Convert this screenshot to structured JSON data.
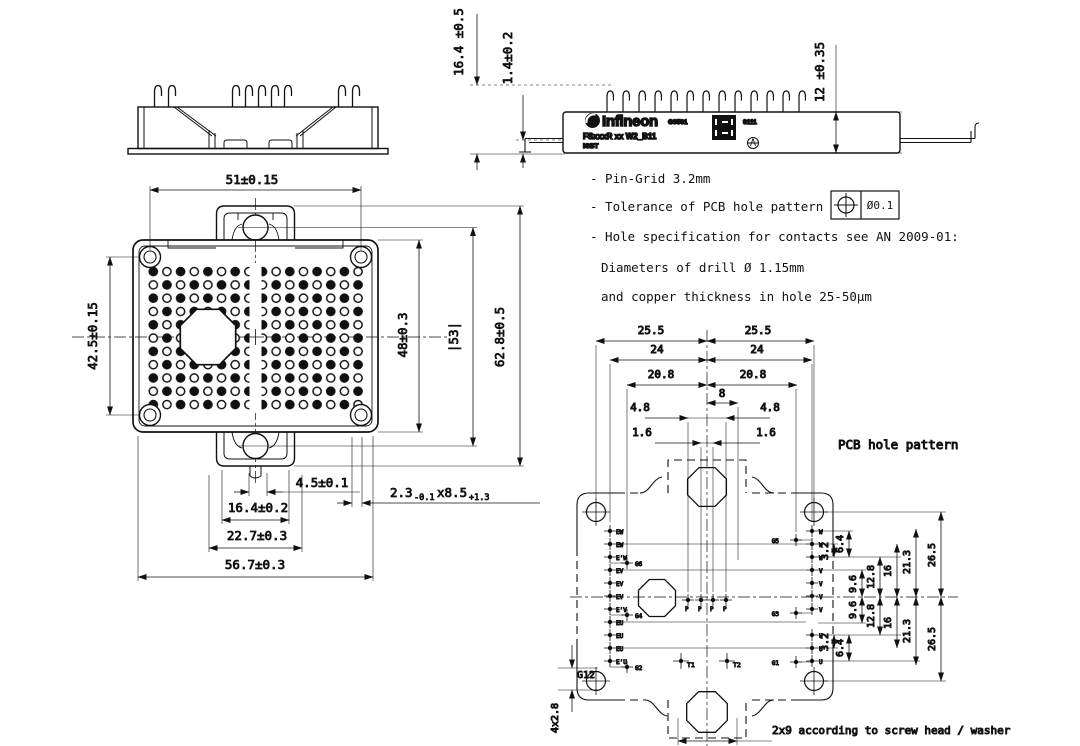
{
  "side_views": {
    "brand": "Infineon",
    "code": "G0501",
    "part": "FSxxxR xx W2_B11",
    "series": "IGBT",
    "batch": "0111"
  },
  "dims": {
    "w51": "51±0.15",
    "h425": "42.5±0.15",
    "h48": "48±0.3",
    "h53": "|53|",
    "h628": "62.8±0.5",
    "w45": "4.5±0.1",
    "w164": "16.4±0.2",
    "w227": "22.7±0.3",
    "w567": "56.7±0.3",
    "slot_main": "2.3",
    "slot_tol1": "-0.1",
    "slot_x": "x8.5",
    "slot_tol2": "+1.3",
    "h164": "16.4 ±0.5",
    "h14": "1.4±0.2",
    "h12": "12 ±0.35"
  },
  "notes": {
    "pin_grid": "- Pin-Grid 3.2mm",
    "tolerance": "- Tolerance of PCB hole pattern",
    "tol_value": "Ø0.1",
    "hole_spec": "- Hole specification for contacts see AN 2009-01:",
    "drill": "Diameters of drill Ø 1.15mm",
    "copper": "and copper thickness in hole 25-50µm"
  },
  "pcb": {
    "title": "PCB hole pattern",
    "screw_note": "2x9 according to screw head / washer",
    "corner_label": "G12",
    "corner_dim": "4x2.8",
    "top_dims": {
      "d255": "25.5",
      "d24": "24",
      "d208": "20.8",
      "d8": "8",
      "d48": "4.8",
      "d16": "1.6"
    },
    "side_dims": {
      "d32": "3.2",
      "d64": "6.4",
      "d96": "9.6",
      "d128": "12.8",
      "d16": "16",
      "d213": "21.3",
      "d265": "26.5"
    },
    "left_pins": [
      "EW",
      "EW",
      "E'W",
      "EV",
      "EV",
      "EV",
      "E'V",
      "EU",
      "EU",
      "EU",
      "E'U"
    ],
    "left_gates": [
      "G6",
      "G4",
      "G2"
    ],
    "right_pins": [
      "W",
      "W",
      "W",
      "V",
      "V",
      "V",
      "V",
      "U",
      "U",
      "U"
    ],
    "right_gates": [
      "G5",
      "G3",
      "G1"
    ],
    "center_pins": [
      "P",
      "P",
      "P",
      "P"
    ],
    "t_pins": [
      "T1",
      "T2"
    ]
  }
}
